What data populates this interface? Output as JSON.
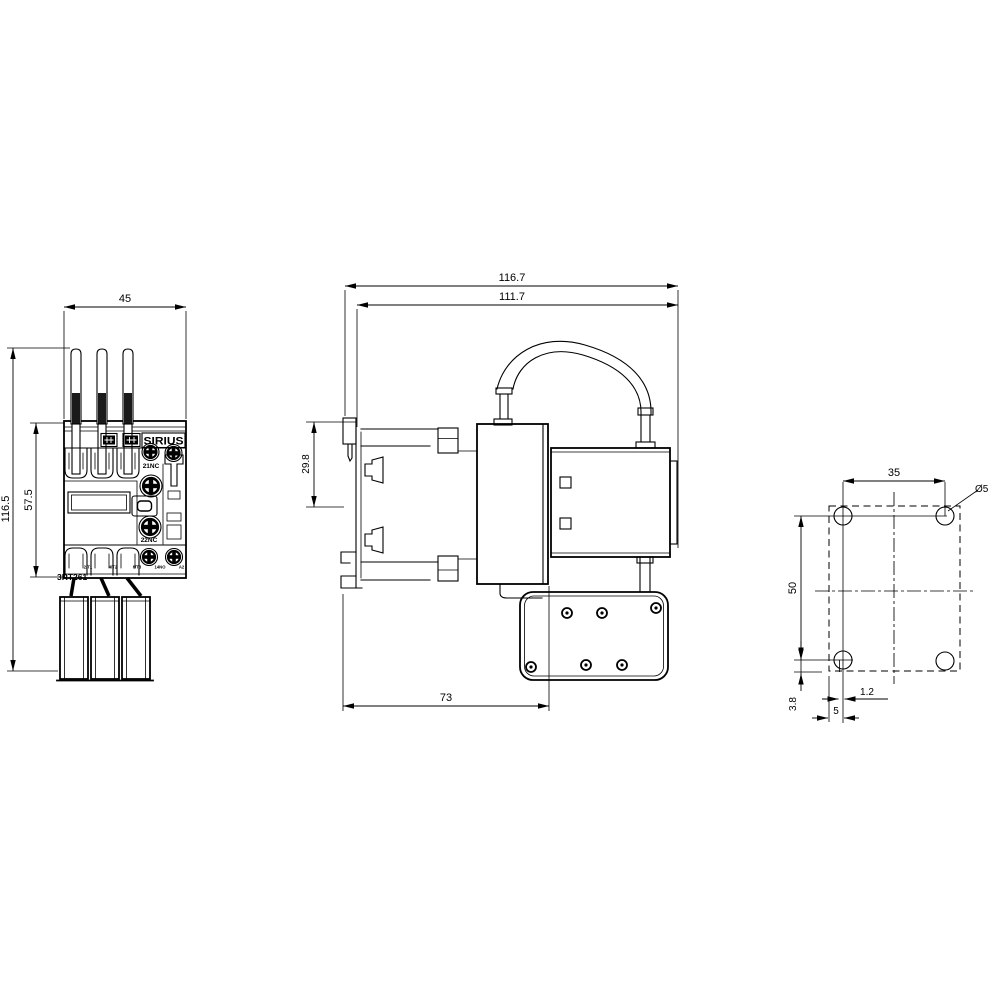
{
  "drawing": {
    "brand": "SIRIUS",
    "model": "3RT261",
    "views": {
      "front": {
        "dims": {
          "width_mm": "45",
          "total_height_mm": "116.5",
          "body_height_mm": "57.5"
        },
        "labels": {
          "aux_contact_top": "21NC",
          "aux_contact_bottom": "22NC"
        },
        "terminals": [
          "2/T1",
          "4/T2",
          "6/T3",
          "14NO",
          "A2"
        ]
      },
      "side": {
        "dims": {
          "total_depth_mm": "116.7",
          "depth_without_clip_mm": "111.7",
          "clip_section_mm": "29.8",
          "body_depth_mm": "73"
        }
      },
      "mounting": {
        "dims": {
          "hole_spacing_horizontal_mm": "35",
          "hole_spacing_vertical_mm": "50",
          "bottom_offset_mm": "3.8",
          "slot_width_mm": "1.2",
          "edge_to_hole_mm": "5",
          "hole_diameter": "Ø5"
        }
      }
    }
  }
}
